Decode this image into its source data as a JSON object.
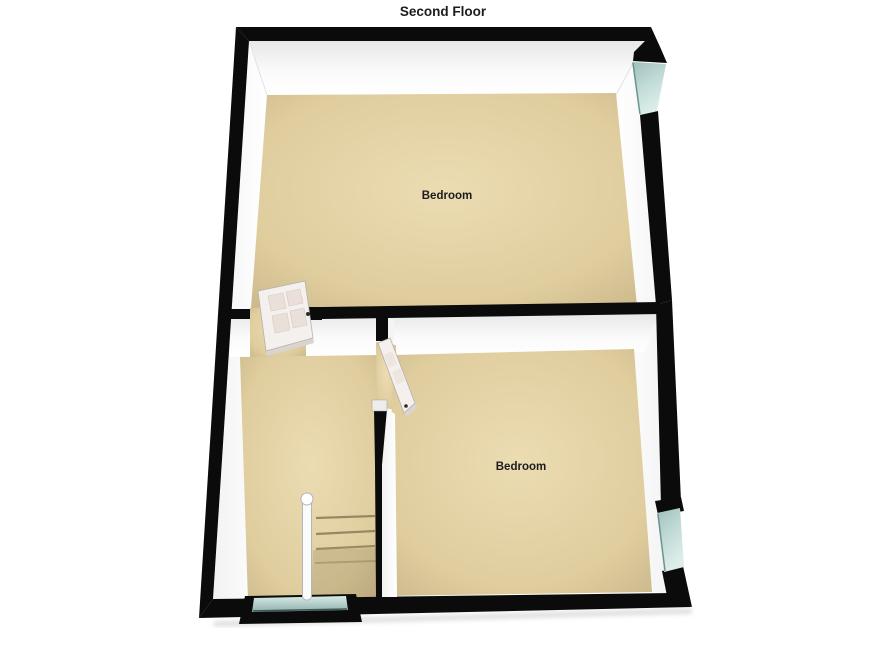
{
  "title": "Second Floor",
  "floorplan": {
    "rooms": [
      {
        "id": "bedroom-top",
        "label": "Bedroom"
      },
      {
        "id": "bedroom-bottom",
        "label": "Bedroom"
      }
    ],
    "features": [
      "window-top-right",
      "window-bottom-right",
      "window-bottom",
      "door-top-bedroom",
      "door-bottom-bedroom",
      "stairs",
      "banister"
    ],
    "colors": {
      "wall": "#0b0b0b",
      "floor": "#dfcd9e",
      "floor_light": "#ecdcb2",
      "floor_dark": "#c7b487",
      "window_glass": "#bdd8d4",
      "window_glass_dark": "#6e918f",
      "door_face": "#f3f0ee",
      "door_panel": "#eadfd9",
      "inner_wall": "#ffffff",
      "inner_wall_shade": "#e7e7e7",
      "shadow": "#dedede",
      "background": "#ffffff",
      "text": "#1c1c1c"
    }
  }
}
